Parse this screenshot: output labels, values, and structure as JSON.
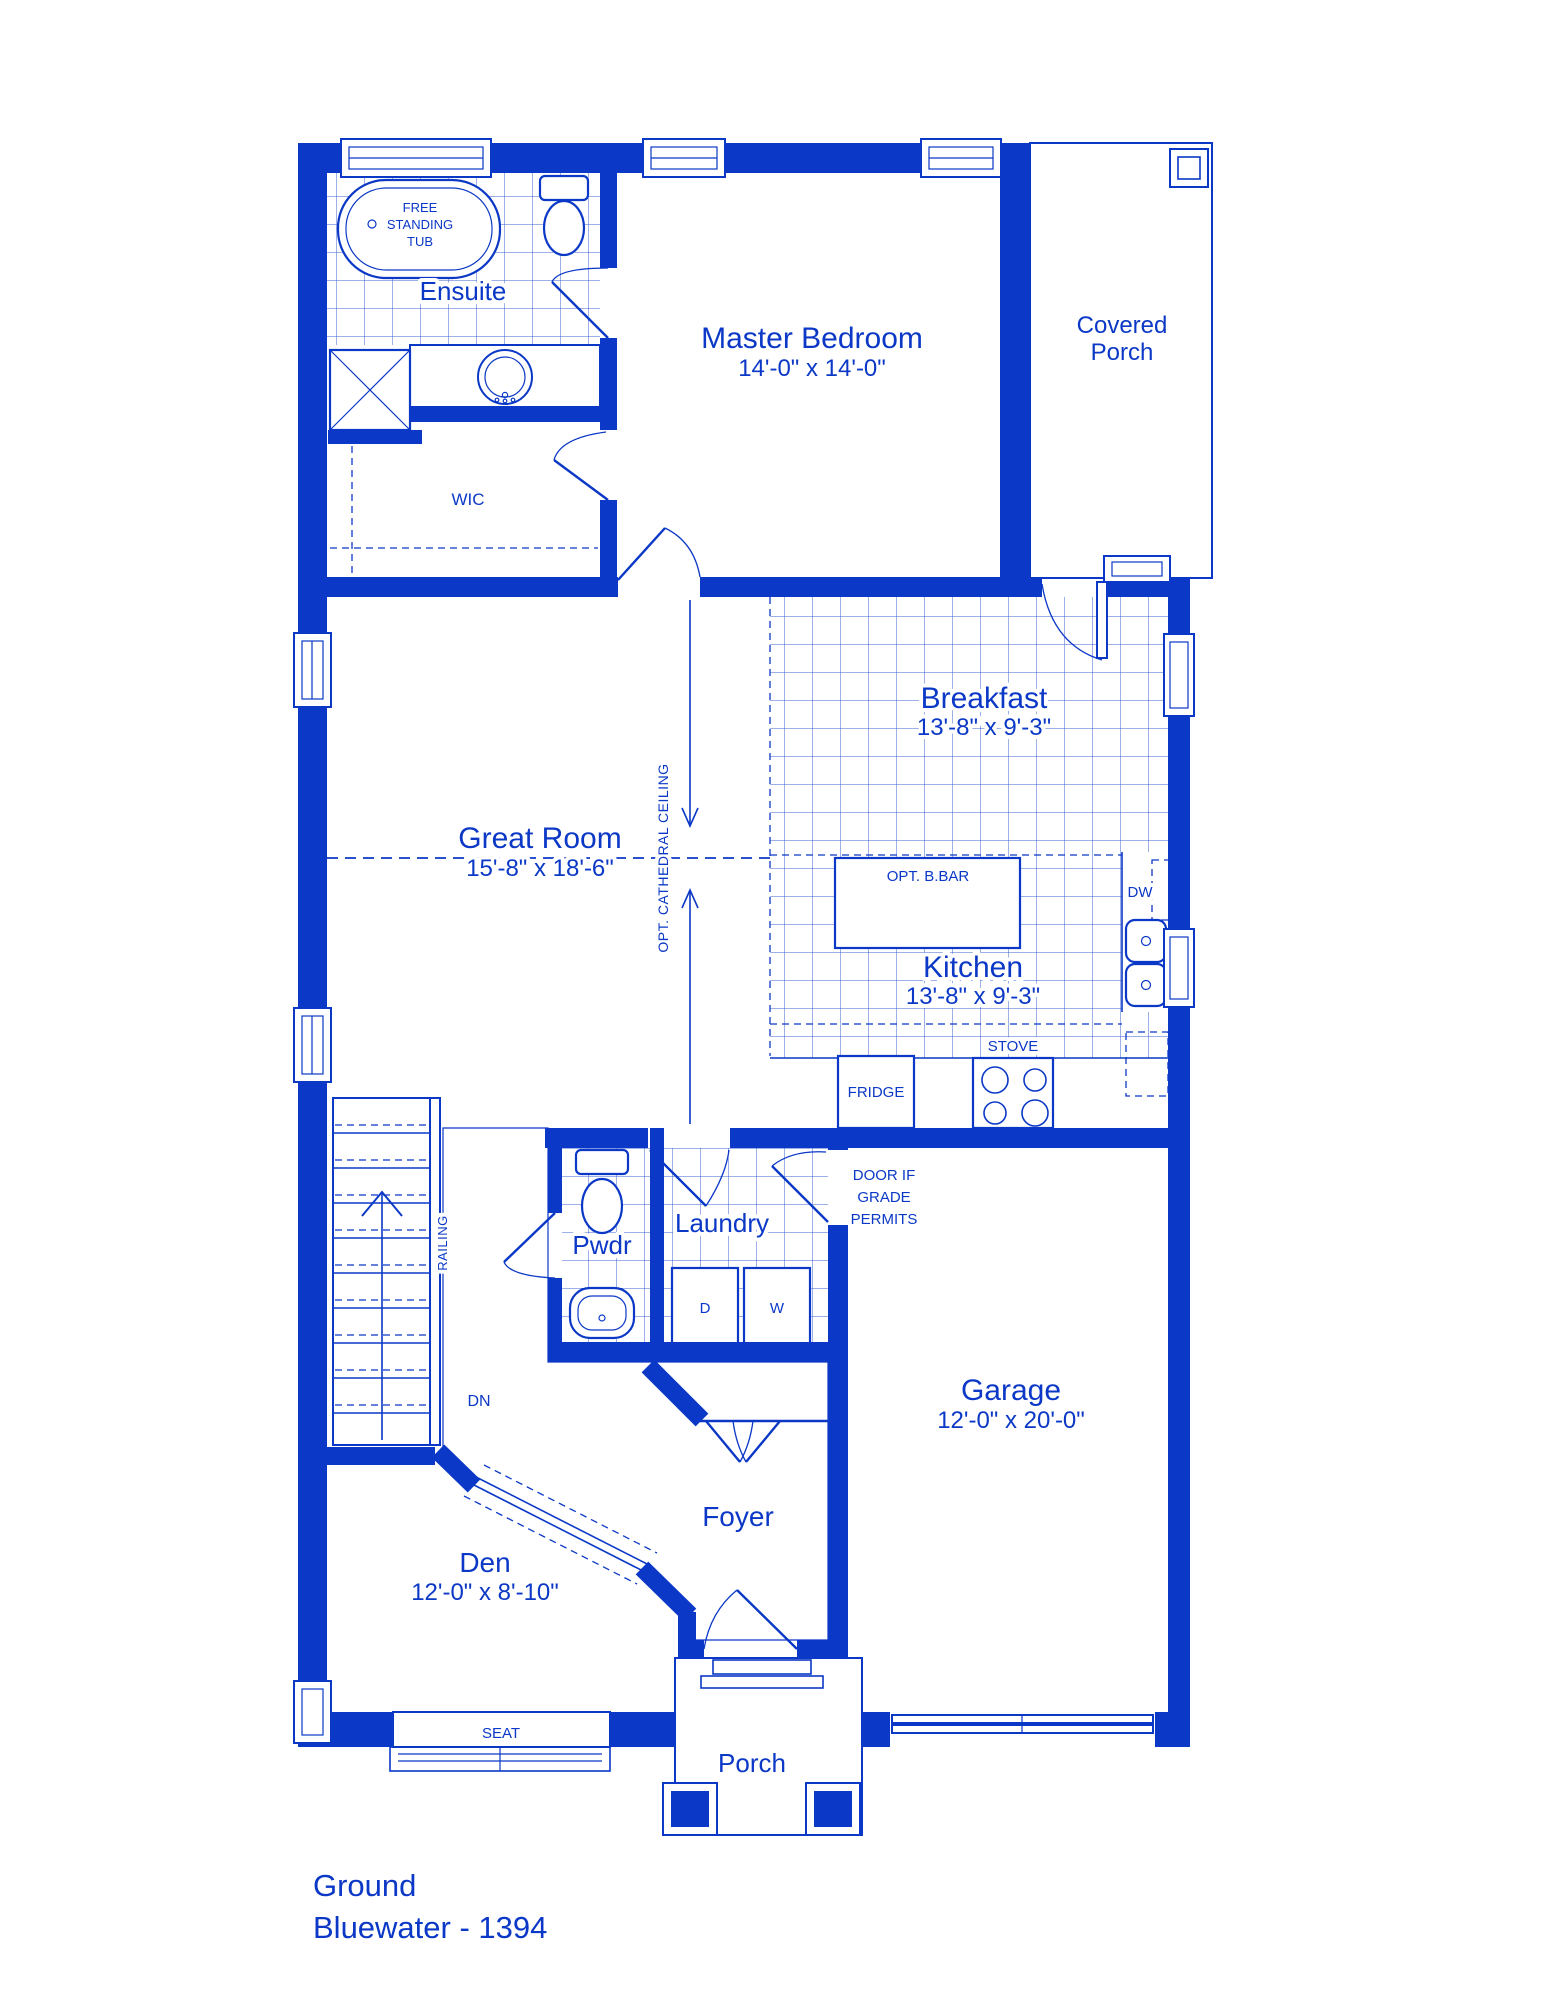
{
  "colors": {
    "ink": "#0b38c6",
    "paper": "#ffffff"
  },
  "title": {
    "floor": "Ground",
    "model": "Bluewater - 1394"
  },
  "rooms": {
    "ensuite": {
      "name": "Ensuite"
    },
    "wic": {
      "name": "WIC"
    },
    "master": {
      "name": "Master Bedroom",
      "dims": "14'-0\" x 14'-0\""
    },
    "covered_porch": {
      "line1": "Covered",
      "line2": "Porch"
    },
    "great_room": {
      "name": "Great Room",
      "dims": "15'-8\" x 18'-6\""
    },
    "breakfast": {
      "name": "Breakfast",
      "dims": "13'-8\" x 9'-3\""
    },
    "kitchen": {
      "name": "Kitchen",
      "dims": "13'-8\" x 9'-3\""
    },
    "pwdr": {
      "name": "Pwdr"
    },
    "laundry": {
      "name": "Laundry"
    },
    "garage": {
      "name": "Garage",
      "dims": "12'-0\" x 20'-0\""
    },
    "foyer": {
      "name": "Foyer"
    },
    "den": {
      "name": "Den",
      "dims": "12'-0\" x 8'-10\""
    },
    "porch": {
      "name": "Porch"
    }
  },
  "fixtures": {
    "tub": {
      "line1": "FREE",
      "line2": "STANDING",
      "line3": "TUB"
    },
    "fridge": "FRIDGE",
    "stove": "STOVE",
    "dw": "DW",
    "dryer": "D",
    "washer": "W",
    "opt_bbar": "OPT. B.BAR",
    "seat": "SEAT"
  },
  "annotations": {
    "opt_cathedral": "OPT. CATHEDRAL CEILING",
    "railing": "RAILING",
    "dn": "DN",
    "grade_door": {
      "line1": "DOOR IF",
      "line2": "GRADE",
      "line3": "PERMITS"
    }
  }
}
